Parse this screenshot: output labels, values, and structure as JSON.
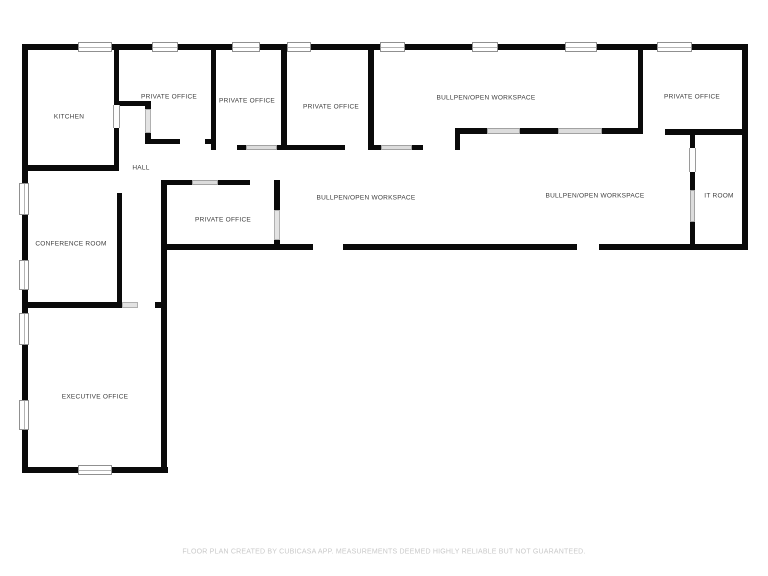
{
  "colors": {
    "wall": "#0a0a0a",
    "room_label": "#3d3d3d",
    "footer_text": "#c9c9c9",
    "window_fill": "#ffffff",
    "door_fill": "#e3e3e3"
  },
  "floor_plan": {
    "rooms": [
      {
        "id": "kitchen",
        "label": "KITCHEN"
      },
      {
        "id": "private_office_1",
        "label": "PRIVATE OFFICE"
      },
      {
        "id": "private_office_2",
        "label": "PRIVATE OFFICE"
      },
      {
        "id": "private_office_3",
        "label": "PRIVATE OFFICE"
      },
      {
        "id": "bullpen_top",
        "label": "BULLPEN/OPEN WORKSPACE"
      },
      {
        "id": "private_office_top_right",
        "label": "PRIVATE OFFICE"
      },
      {
        "id": "hall",
        "label": "HALL"
      },
      {
        "id": "private_office_middle",
        "label": "PRIVATE OFFICE"
      },
      {
        "id": "bullpen_left",
        "label": "BULLPEN/OPEN WORKSPACE"
      },
      {
        "id": "bullpen_right",
        "label": "BULLPEN/OPEN WORKSPACE"
      },
      {
        "id": "it_room",
        "label": "IT ROOM"
      },
      {
        "id": "conference_room",
        "label": "CONFERENCE ROOM"
      },
      {
        "id": "executive_office",
        "label": "EXECUTIVE OFFICE"
      }
    ],
    "footer": "FLOOR PLAN CREATED BY CUBICASA APP. MEASUREMENTS DEEMED HIGHLY RELIABLE BUT NOT GUARANTEED."
  }
}
